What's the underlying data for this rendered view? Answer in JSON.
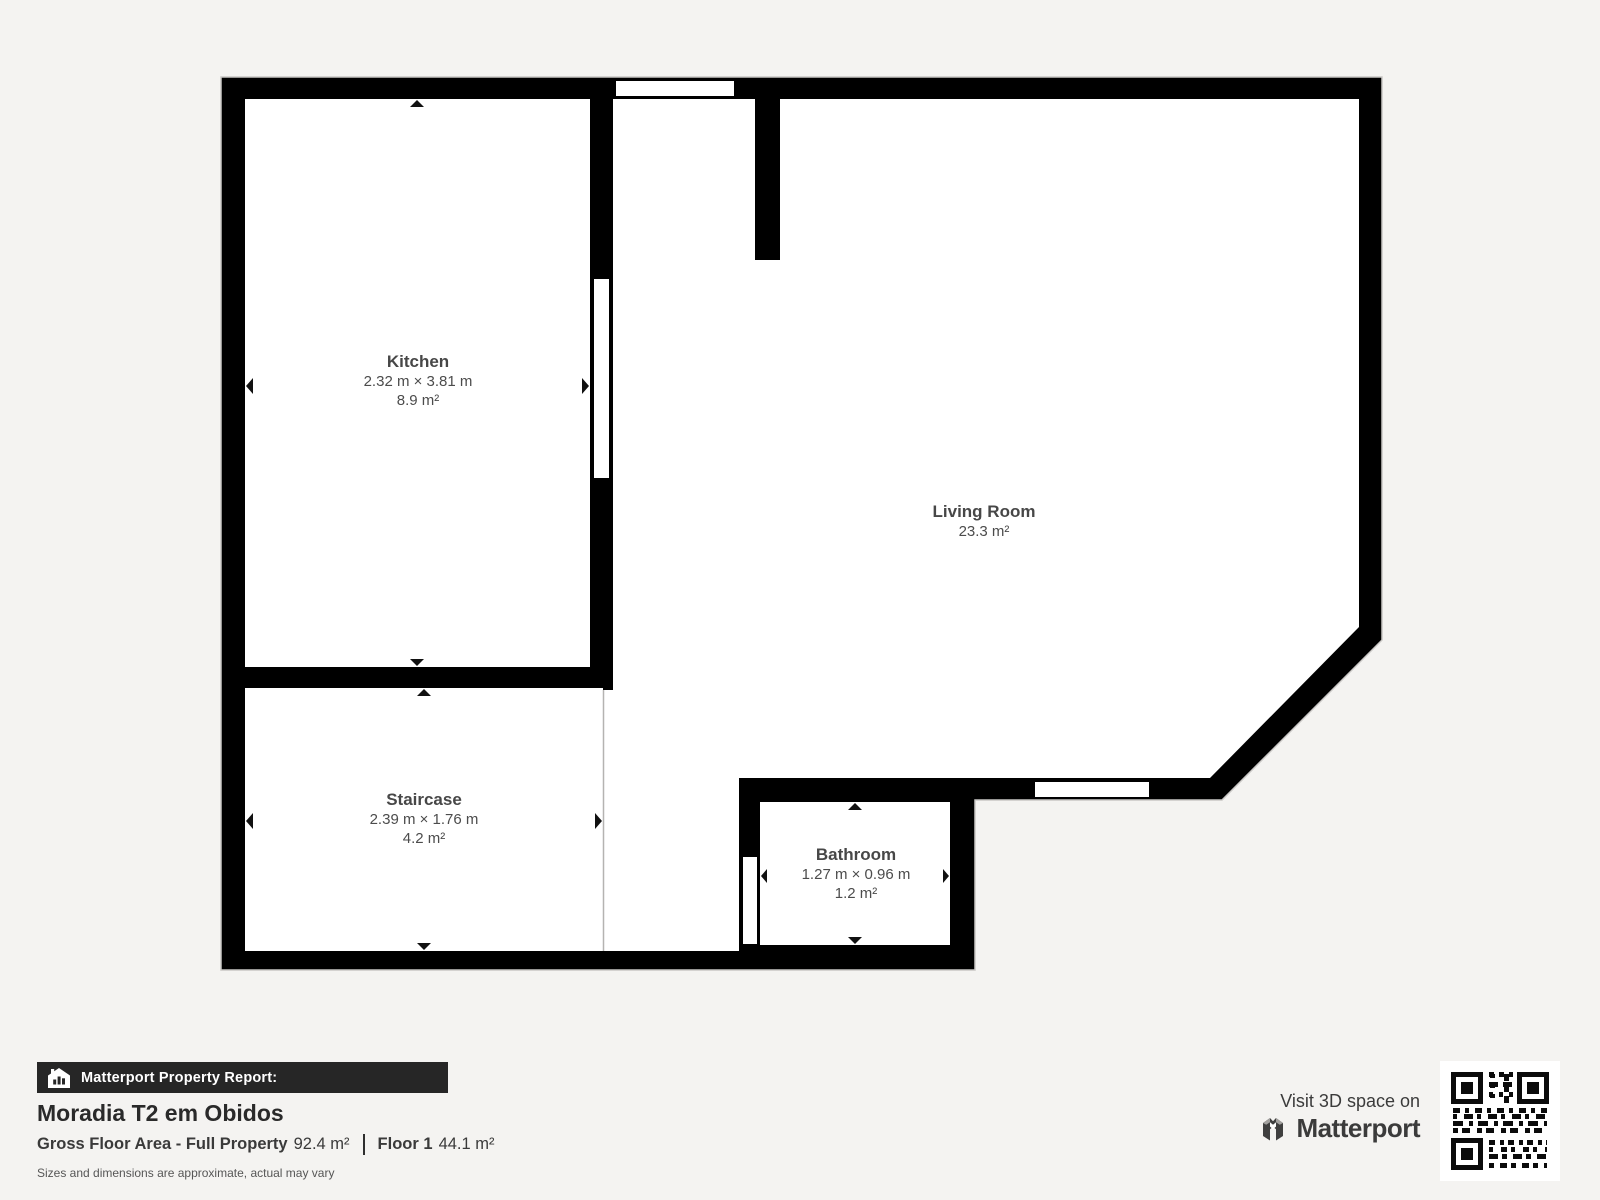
{
  "floorplan": {
    "rooms": {
      "kitchen": {
        "name": "Kitchen",
        "dimensions": "2.32 m × 3.81 m",
        "area": "8.9 m²"
      },
      "living": {
        "name": "Living Room",
        "area": "23.3 m²"
      },
      "staircase": {
        "name": "Staircase",
        "dimensions": "2.39 m × 1.76 m",
        "area": "4.2 m²"
      },
      "bathroom": {
        "name": "Bathroom",
        "dimensions": "1.27 m × 0.96 m",
        "area": "1.2 m²"
      }
    },
    "colors": {
      "wall": "#000000",
      "floor": "#ffffff",
      "background": "#f4f3f1",
      "label_text": "#4c4c4c"
    }
  },
  "report": {
    "bar_label": "Matterport Property Report:",
    "property_name": "Moradia T2 em Obidos",
    "gross_floor_label": "Gross Floor Area - Full Property",
    "gross_floor_value": "92.4 m²",
    "floor_label": "Floor 1",
    "floor_value": "44.1 m²",
    "disclaimer": "Sizes and dimensions are approximate, actual may vary"
  },
  "promo": {
    "visit_text": "Visit 3D space on",
    "brand": "Matterport"
  }
}
